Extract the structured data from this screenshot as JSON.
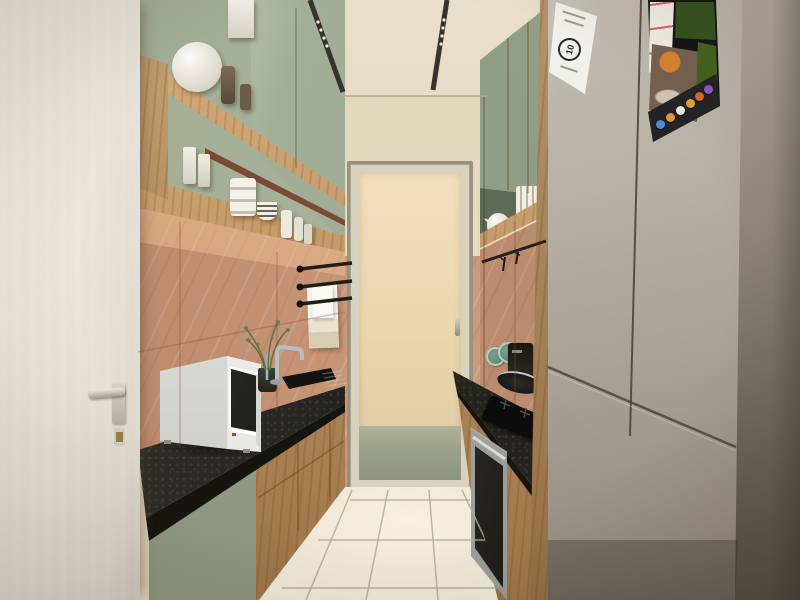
{
  "meta": {
    "title": "Parallel modular kitchen — interior 3D render",
    "view": "one-point perspective galley"
  },
  "palette": {
    "wall-cream": "#e7dcc5",
    "ceiling": "#ded4bf",
    "cabinet-green": "#a6b199",
    "wood": "#c2955e",
    "marble": "#cb9a7b",
    "counter": "#24231d",
    "floor": "#ebe3d1",
    "fridge": "#b5aea3",
    "right-wall": "#6f6b5f",
    "towel": "#f3efe5",
    "track": "#36322c",
    "plant": "#5d7048"
  },
  "objects": {
    "left_door": {
      "type": "entry door, white, lever handle with key"
    },
    "left_run": {
      "upper": "sage-green cabinets with open wood shelves",
      "crockery": "white tureen, bowls, jars, canisters, striped bowls",
      "appliance": "white microwave oven",
      "fixtures": "black towel rail with white towels, chrome mixer tap, undermount sink, potted plant"
    },
    "back": {
      "feature": "tall frosted-glass service door"
    },
    "right_run": {
      "upper": "sage-green cabinets with open wood shelf, teapot and plates",
      "counter": "black granite, gas hob, frying pan, coffee maker, green plates",
      "appliance": "built-in oven"
    },
    "fridge": {
      "type": "smart refrigerator with touchscreen",
      "sticker_label": "10",
      "screen_app_colors": [
        "#4a8fd4",
        "#e2913c",
        "#e8e6de",
        "#d9a43a",
        "#cf6a2e",
        "#9059bb"
      ]
    }
  }
}
